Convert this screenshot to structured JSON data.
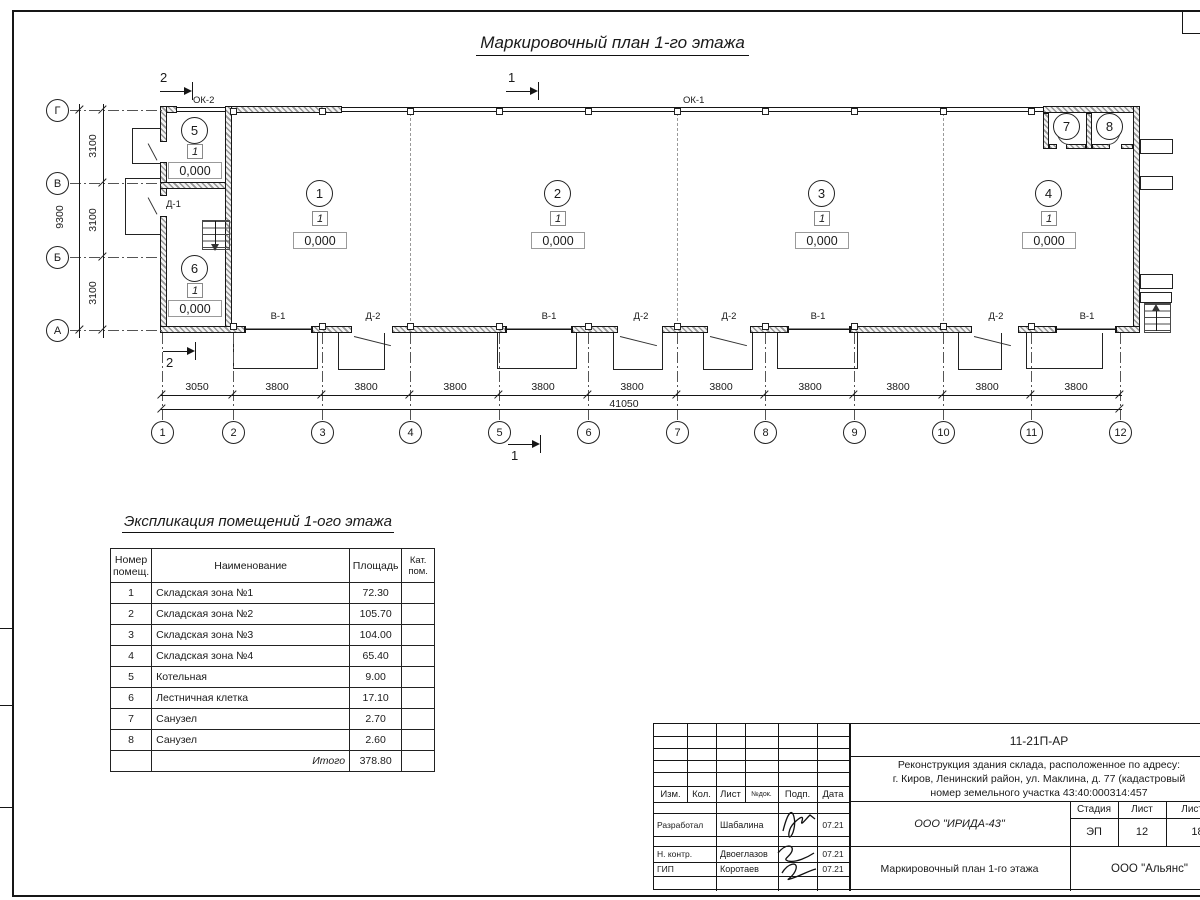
{
  "title": "Маркировочный план 1-го этажа",
  "plan": {
    "labels": {
      "ok1": "ОК-1",
      "ok2": "ОК-2",
      "d1": "Д-1"
    },
    "sections": {
      "top_left": "2",
      "top_mid": "1",
      "bottom_left": "2",
      "bottom_mid": "1"
    },
    "rooms": [
      {
        "num": "1",
        "unit": "1",
        "level": "0,000"
      },
      {
        "num": "2",
        "unit": "1",
        "level": "0,000"
      },
      {
        "num": "3",
        "unit": "1",
        "level": "0,000"
      },
      {
        "num": "4",
        "unit": "1",
        "level": "0,000"
      },
      {
        "num": "5",
        "unit": "1",
        "level": "0,000"
      },
      {
        "num": "6",
        "unit": "1",
        "level": "0,000"
      },
      {
        "num": "7"
      },
      {
        "num": "8"
      }
    ],
    "openings": [
      "В-1",
      "Д-2",
      "В-1",
      "Д-2",
      "Д-2",
      "В-1",
      "Д-2",
      "В-1"
    ],
    "row_axes": [
      "Г",
      "В",
      "Б",
      "А"
    ],
    "col_axes": [
      "1",
      "2",
      "3",
      "4",
      "5",
      "6",
      "7",
      "8",
      "9",
      "10",
      "11",
      "12"
    ],
    "dims": {
      "left_segments": [
        "3100",
        "3100",
        "3100"
      ],
      "left_total": "9300",
      "bottom_segments": [
        "3050",
        "3800",
        "3800",
        "3800",
        "3800",
        "3800",
        "3800",
        "3800",
        "3800",
        "3800",
        "3800"
      ],
      "bottom_total": "41050"
    }
  },
  "explication": {
    "title": "Экспликация помещений 1-ого этажа",
    "headers": [
      "Номер помещ.",
      "Наименование",
      "Площадь",
      "Кат. пом."
    ],
    "rows": [
      [
        "1",
        "Складская зона №1",
        "72.30"
      ],
      [
        "2",
        "Складская зона №2",
        "105.70"
      ],
      [
        "3",
        "Складская зона №3",
        "104.00"
      ],
      [
        "4",
        "Складская зона №4",
        "65.40"
      ],
      [
        "5",
        "Котельная",
        "9.00"
      ],
      [
        "6",
        "Лестничная клетка",
        "17.10"
      ],
      [
        "7",
        "Санузел",
        "2.70"
      ],
      [
        "8",
        "Санузел",
        "2.60"
      ]
    ],
    "total_label": "Итого",
    "total": "378.80"
  },
  "stamp": {
    "code": "11-21П-АР",
    "desc1": "Реконструкция здания склада, расположенное по адресу:",
    "desc2": "г. Киров, Ленинский район, ул. Маклина, д. 77 (кадастровый",
    "desc3": "номер земельного участка 43:40:000314:457",
    "rev_headers": [
      "Изм.",
      "Кол.",
      "Лист",
      "№док.",
      "Подп.",
      "Дата"
    ],
    "roles": [
      {
        "role": "Разработал",
        "name": "Шабалина",
        "date": "07.21"
      },
      {
        "role": "Н. контр.",
        "name": "Двоеглазов",
        "date": "07.21"
      },
      {
        "role": "ГИП",
        "name": "Коротаев",
        "date": "07.21"
      }
    ],
    "designer": "ООО \"ИРИДА-43\"",
    "stage_label": "Стадия",
    "sheet_label": "Лист",
    "sheets_label": "Листов",
    "stage": "ЭП",
    "sheet": "12",
    "sheets": "18",
    "doc_title": "Маркировочный план 1-го этажа",
    "org": "ООО \"Альянс\""
  }
}
